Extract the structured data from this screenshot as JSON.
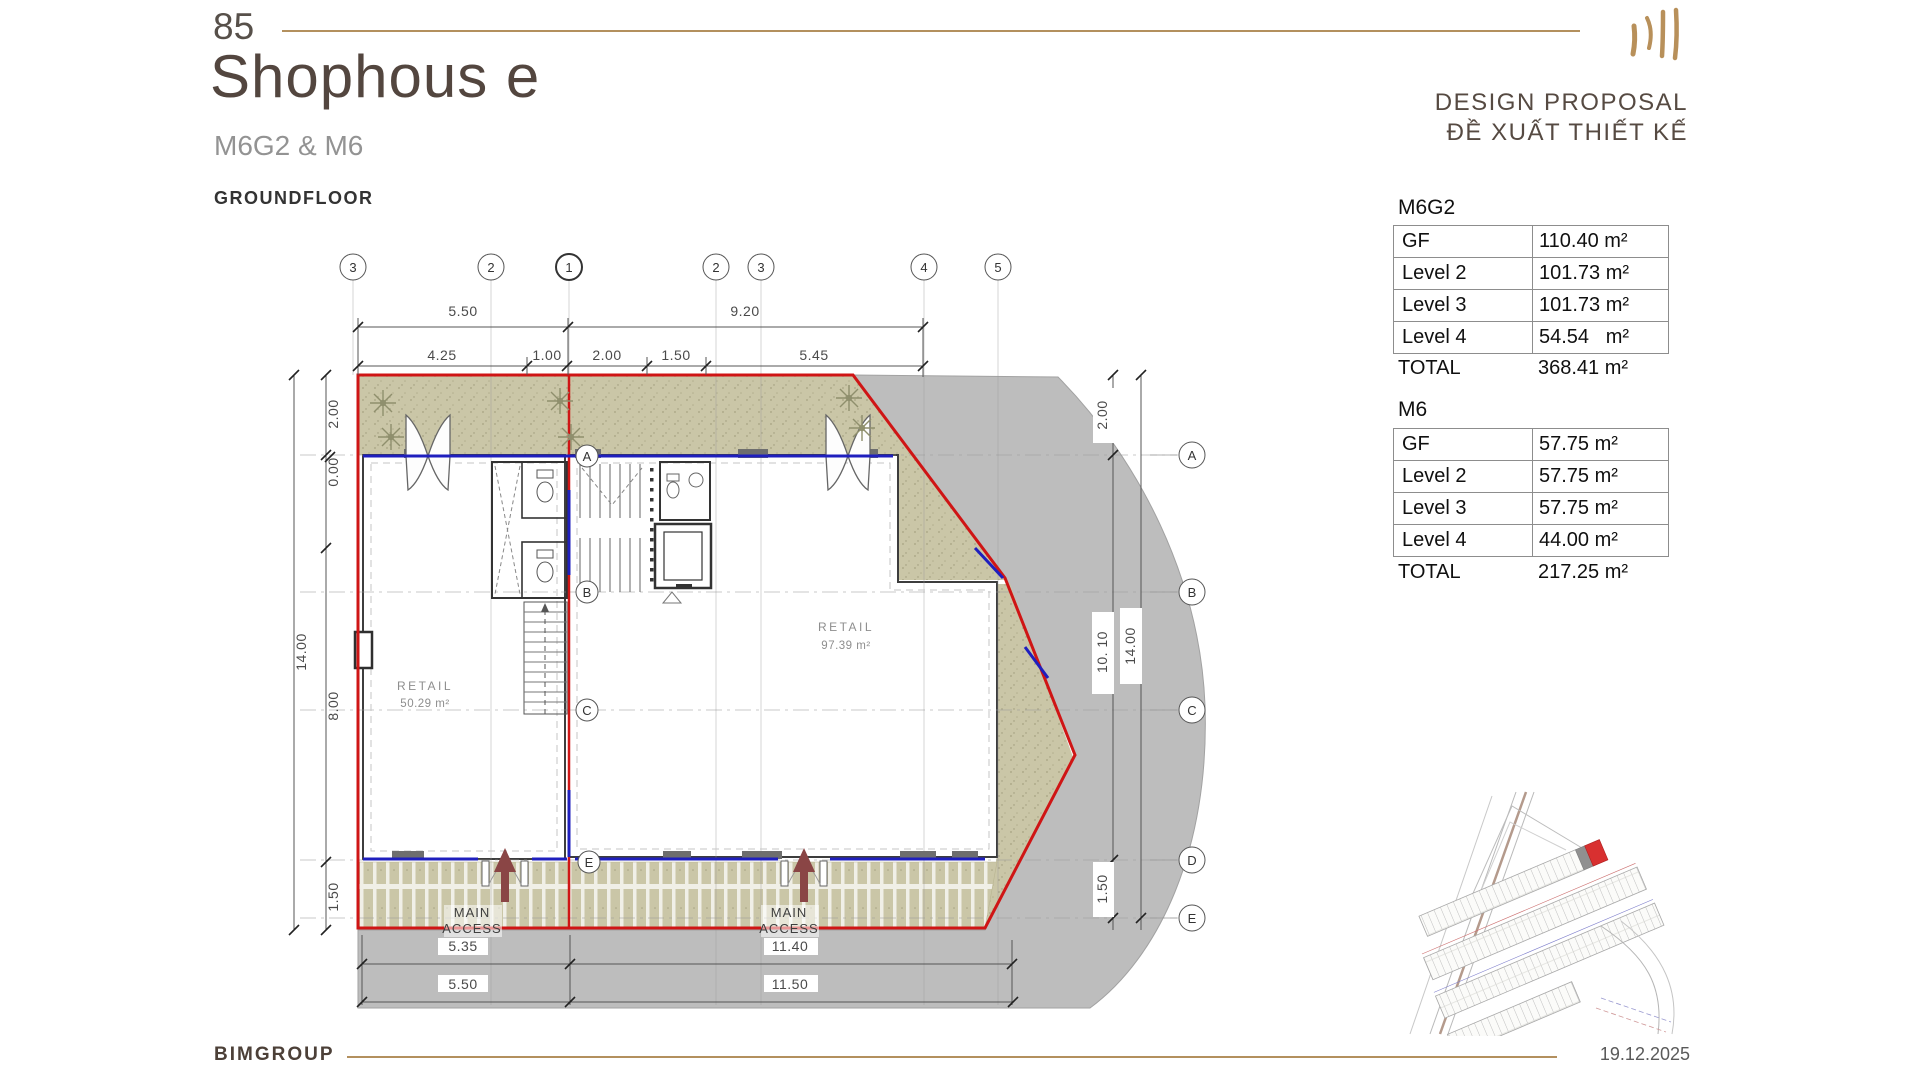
{
  "header": {
    "page_number": "85",
    "title": "Shophous e",
    "subtitle": "M6G2 & M6",
    "floor_label": "GROUNDFLOOR",
    "proposal_line1": "DESIGN PROPOSAL",
    "proposal_line2": "ĐỀ XUẤT THIẾT KẾ"
  },
  "area_tables": [
    {
      "name": "M6G2",
      "rows": [
        {
          "label": "GF",
          "value": "110.40 m²"
        },
        {
          "label": "Level 2",
          "value": "101.73 m²"
        },
        {
          "label": "Level 3",
          "value": "101.73 m²"
        },
        {
          "label": "Level 4",
          "value": "54.54   m²"
        }
      ],
      "total_label": "TOTAL",
      "total_value": "368.41 m²"
    },
    {
      "name": "M6",
      "rows": [
        {
          "label": "GF",
          "value": "57.75 m²"
        },
        {
          "label": "Level 2",
          "value": "57.75 m²"
        },
        {
          "label": "Level 3",
          "value": "57.75 m²"
        },
        {
          "label": "Level 4",
          "value": "44.00 m²"
        }
      ],
      "total_label": "TOTAL",
      "total_value": "217.25 m²"
    }
  ],
  "plan": {
    "grid_columns_top": [
      "3",
      "2",
      "1",
      "2",
      "3",
      "4",
      "5"
    ],
    "grid_rows_right": [
      "A",
      "B",
      "C",
      "D",
      "E"
    ],
    "grid_rows_inner": [
      "A",
      "B",
      "C",
      "E"
    ],
    "dims": {
      "top_row1": [
        "5.50",
        "9.20"
      ],
      "top_row2": [
        "4.25",
        "1.00",
        "2.00",
        "1.50",
        "5.45"
      ],
      "left": [
        "2.00",
        "0.00",
        "14.00",
        "8.00",
        "1.50"
      ],
      "right": [
        "2.00",
        "10. 10",
        "14.00",
        "1.50"
      ],
      "bottom_row1": [
        "5.35",
        "11.40"
      ],
      "bottom_row2": [
        "5.50",
        "11.50"
      ]
    },
    "rooms": [
      {
        "name": "RETAIL",
        "area": "50.29 m²"
      },
      {
        "name": "RETAIL",
        "area": "97.39 m²"
      }
    ],
    "access_line1": "MAIN",
    "access_line2": "ACCESS"
  },
  "footer": {
    "company": "BIMGROUP",
    "date": "19.12.2025"
  },
  "colors": {
    "accent_gold": "#b3905e",
    "boundary_red": "#cf1515",
    "storefront_blue": "#1f1fbe",
    "landscape_green": "#cac6a7",
    "road_gray": "#bdbdbd",
    "highlight_lot_red": "#d83030"
  }
}
